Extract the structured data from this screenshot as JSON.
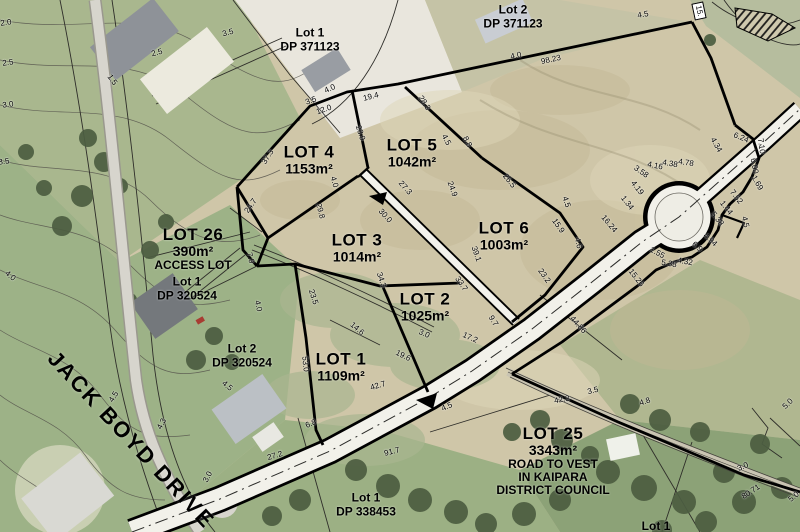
{
  "map": {
    "street": {
      "label": "JACK BOYD DRIVE"
    },
    "road_tag": {
      "label": "15."
    },
    "colors": {
      "boundary": "#000000",
      "road_fill": "#f2f1ea",
      "aerial_green": "#9db287",
      "aerial_tan": "#cfc6a8",
      "tree_green": "#4c5d41"
    },
    "lot_labels": [
      {
        "name": "LOT 4",
        "area": "1153m²",
        "x": 309,
        "y": 160
      },
      {
        "name": "LOT 5",
        "area": "1042m²",
        "x": 412,
        "y": 153
      },
      {
        "name": "LOT 3",
        "area": "1014m²",
        "x": 357,
        "y": 248
      },
      {
        "name": "LOT 6",
        "area": "1003m²",
        "x": 504,
        "y": 236
      },
      {
        "name": "LOT 2",
        "area": "1025m²",
        "x": 425,
        "y": 307
      },
      {
        "name": "LOT 1",
        "area": "1109m²",
        "x": 341,
        "y": 367
      },
      {
        "name": "LOT 26",
        "area": "390m²",
        "notes": [
          "ACCESS LOT"
        ],
        "x": 193,
        "y": 249
      },
      {
        "name": "LOT 25",
        "area": "3343m²",
        "notes": [
          "ROAD TO VEST",
          "IN KAIPARA",
          "DISTRICT COUNCIL"
        ],
        "x": 553,
        "y": 461
      }
    ],
    "parcel_labels": [
      {
        "line1": "Lot 1",
        "line2": "DP 371123",
        "x": 310,
        "y": 40
      },
      {
        "line1": "Lot 2",
        "line2": "DP 371123",
        "x": 513,
        "y": 17
      },
      {
        "line1": "Lot 1",
        "line2": "DP 320524",
        "x": 187,
        "y": 289
      },
      {
        "line1": "Lot 2",
        "line2": "DP 320524",
        "x": 242,
        "y": 356
      },
      {
        "line1": "Lot 1",
        "line2": "DP 338453",
        "x": 366,
        "y": 505
      },
      {
        "line1": "Lot 1",
        "line2": "",
        "x": 656,
        "y": 526
      }
    ],
    "measurements": [
      {
        "t": "3.5",
        "x": 311,
        "y": 101,
        "r": -20
      },
      {
        "t": "12.0",
        "x": 324,
        "y": 110,
        "r": -20
      },
      {
        "t": "19.4",
        "x": 371,
        "y": 97,
        "r": -14
      },
      {
        "t": "4.0",
        "x": 330,
        "y": 89,
        "r": -25
      },
      {
        "t": "4.0",
        "x": 516,
        "y": 56,
        "r": -12
      },
      {
        "t": "98.23",
        "x": 551,
        "y": 60,
        "r": -12
      },
      {
        "t": "28.3",
        "x": 424,
        "y": 103,
        "r": 58
      },
      {
        "t": "23.9",
        "x": 360,
        "y": 133,
        "r": 72
      },
      {
        "t": "37.3",
        "x": 268,
        "y": 157,
        "r": -58
      },
      {
        "t": "4.5",
        "x": 446,
        "y": 140,
        "r": 62
      },
      {
        "t": "8.8",
        "x": 467,
        "y": 142,
        "r": 62
      },
      {
        "t": "24.7",
        "x": 251,
        "y": 206,
        "r": -55
      },
      {
        "t": "29.8",
        "x": 320,
        "y": 211,
        "r": 75
      },
      {
        "t": "4.0",
        "x": 334,
        "y": 182,
        "r": 75
      },
      {
        "t": "27.3",
        "x": 405,
        "y": 188,
        "r": 48
      },
      {
        "t": "30.0",
        "x": 385,
        "y": 216,
        "r": 48
      },
      {
        "t": "24.9",
        "x": 452,
        "y": 189,
        "r": 70
      },
      {
        "t": "26.5",
        "x": 509,
        "y": 181,
        "r": 52
      },
      {
        "t": "4.5",
        "x": 566,
        "y": 202,
        "r": 72
      },
      {
        "t": "15.9",
        "x": 558,
        "y": 226,
        "r": 55
      },
      {
        "t": "39.1",
        "x": 476,
        "y": 254,
        "r": 70
      },
      {
        "t": "33.7",
        "x": 461,
        "y": 284,
        "r": 55
      },
      {
        "t": "23.2",
        "x": 544,
        "y": 276,
        "r": 55
      },
      {
        "t": "4.6",
        "x": 578,
        "y": 243,
        "r": 78
      },
      {
        "t": "16.24",
        "x": 609,
        "y": 224,
        "r": 50
      },
      {
        "t": "1.34",
        "x": 627,
        "y": 203,
        "r": 52
      },
      {
        "t": "4.19",
        "x": 637,
        "y": 188,
        "r": 52
      },
      {
        "t": "3.58",
        "x": 641,
        "y": 172,
        "r": 35
      },
      {
        "t": "4.16",
        "x": 655,
        "y": 166,
        "r": 12
      },
      {
        "t": "4.38",
        "x": 670,
        "y": 164,
        "r": 10
      },
      {
        "t": "4.78",
        "x": 686,
        "y": 163,
        "r": 8
      },
      {
        "t": "4.34",
        "x": 716,
        "y": 145,
        "r": 60
      },
      {
        "t": "6.24",
        "x": 741,
        "y": 138,
        "r": 22
      },
      {
        "t": "7.10",
        "x": 761,
        "y": 146,
        "r": 82
      },
      {
        "t": "6.00",
        "x": 754,
        "y": 166,
        "r": 80
      },
      {
        "t": "1.69",
        "x": 757,
        "y": 183,
        "r": 60
      },
      {
        "t": "7.52",
        "x": 736,
        "y": 197,
        "r": 52
      },
      {
        "t": "1.44",
        "x": 726,
        "y": 208,
        "r": 52
      },
      {
        "t": "5.38",
        "x": 717,
        "y": 219,
        "r": 52
      },
      {
        "t": "4.5",
        "x": 745,
        "y": 222,
        "r": 78
      },
      {
        "t": "6.9",
        "x": 697,
        "y": 247,
        "r": 42
      },
      {
        "t": "4.94",
        "x": 710,
        "y": 240,
        "r": 42
      },
      {
        "t": "1.55",
        "x": 657,
        "y": 253,
        "r": 28
      },
      {
        "t": "5.38",
        "x": 669,
        "y": 264,
        "r": 10
      },
      {
        "t": "4.32",
        "x": 685,
        "y": 262,
        "r": 10
      },
      {
        "t": "15.26",
        "x": 636,
        "y": 278,
        "r": 52
      },
      {
        "t": "44.86",
        "x": 578,
        "y": 325,
        "r": 48
      },
      {
        "t": "9.7",
        "x": 493,
        "y": 321,
        "r": 58
      },
      {
        "t": "17.2",
        "x": 470,
        "y": 338,
        "r": 24
      },
      {
        "t": "3.0",
        "x": 424,
        "y": 334,
        "r": 24
      },
      {
        "t": "19.6",
        "x": 403,
        "y": 356,
        "r": 26
      },
      {
        "t": "14.6",
        "x": 357,
        "y": 329,
        "r": 40
      },
      {
        "t": "23.5",
        "x": 313,
        "y": 297,
        "r": 72
      },
      {
        "t": "34.3",
        "x": 381,
        "y": 280,
        "r": 72
      },
      {
        "t": "53.0",
        "x": 305,
        "y": 364,
        "r": 84
      },
      {
        "t": "42.7",
        "x": 378,
        "y": 386,
        "r": -16
      },
      {
        "t": "6.8",
        "x": 311,
        "y": 424,
        "r": -22
      },
      {
        "t": "27.2",
        "x": 275,
        "y": 456,
        "r": -16
      },
      {
        "t": "91.7",
        "x": 392,
        "y": 452,
        "r": -14
      },
      {
        "t": "4.5",
        "x": 447,
        "y": 407,
        "r": -24
      },
      {
        "t": "42.3",
        "x": 562,
        "y": 400,
        "r": -10
      },
      {
        "t": "3.5",
        "x": 593,
        "y": 391,
        "r": -14
      },
      {
        "t": "4.8",
        "x": 645,
        "y": 402,
        "r": -18
      },
      {
        "t": "5.0",
        "x": 788,
        "y": 404,
        "r": -45
      },
      {
        "t": "3.0",
        "x": 743,
        "y": 467,
        "r": -24
      },
      {
        "t": "80.71",
        "x": 751,
        "y": 492,
        "r": -33
      },
      {
        "t": "5.0",
        "x": 794,
        "y": 497,
        "r": -40
      },
      {
        "t": "4.5",
        "x": 643,
        "y": 15,
        "r": -10
      },
      {
        "t": "4.5",
        "x": 114,
        "y": 397,
        "r": -58
      },
      {
        "t": "4.3",
        "x": 162,
        "y": 424,
        "r": -62
      },
      {
        "t": "3.0",
        "x": 208,
        "y": 477,
        "r": -62
      },
      {
        "t": "7.9",
        "x": 250,
        "y": 258,
        "r": 75
      },
      {
        "t": "4.0",
        "x": 258,
        "y": 306,
        "r": 78
      },
      {
        "t": "4.5",
        "x": 227,
        "y": 386,
        "r": 40
      }
    ],
    "contour_labels": [
      {
        "t": "2.0",
        "x": 6,
        "y": 23,
        "r": -8
      },
      {
        "t": "2.5",
        "x": 8,
        "y": 63,
        "r": -8
      },
      {
        "t": "3.0",
        "x": 8,
        "y": 105,
        "r": -8
      },
      {
        "t": "3.5",
        "x": 4,
        "y": 162,
        "r": -8
      },
      {
        "t": "2.5",
        "x": 157,
        "y": 53,
        "r": -15
      },
      {
        "t": "3.5",
        "x": 228,
        "y": 33,
        "r": -15
      },
      {
        "t": "1.5",
        "x": 112,
        "y": 80,
        "r": 55
      },
      {
        "t": "4.0",
        "x": 10,
        "y": 276,
        "r": 40
      }
    ]
  }
}
